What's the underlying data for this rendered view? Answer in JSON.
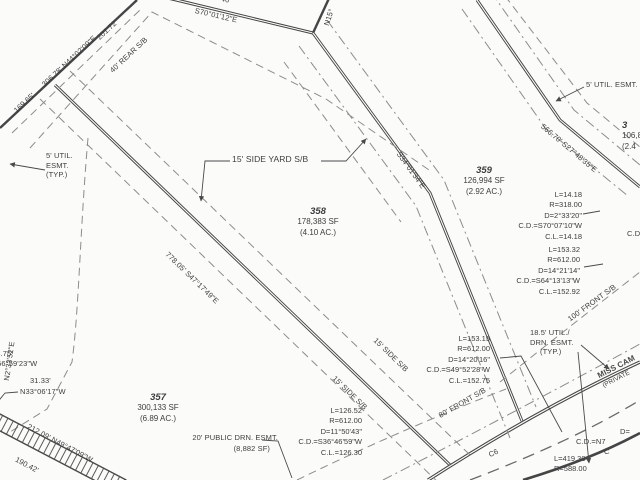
{
  "colors": {
    "ink": "#3d3d3d",
    "line": "#4a4a4a",
    "dash": "#8c8c8c",
    "background": "#fbfbf9"
  },
  "lots": {
    "lot357": {
      "number": "357",
      "area_sf": "300,133 SF",
      "area_ac": "(6.89 AC.)"
    },
    "lot358": {
      "number": "358",
      "area_sf": "178,383 SF",
      "area_ac": "(4.10 AC.)"
    },
    "lot359": {
      "number": "359",
      "area_sf": "126,994 SF",
      "area_ac": "(2.92 AC.)"
    },
    "lot_right_partial": {
      "number": "3",
      "area_sf": "106,8",
      "area_ac": "(2.4"
    }
  },
  "bearings": {
    "north_boundary": "306.78' N44°02'09\"E",
    "seg_169": "169.65'",
    "seg_201": "201.72'",
    "top_bearing": "S70°01'12\"E",
    "top_partial": "46'",
    "corner_partial": "N15°",
    "lot_line_358_359": "S34°01'34\"E",
    "lot_line_359_360": "566.70' S27°48'35\"E",
    "lot_line_357_358": "778.05' S47°17'49\"E",
    "west_partial": "N2°33'52\"E",
    "west_dist1": "43.75'",
    "west_brg1": "S56°59'23\"W",
    "west_dist2": "31.33'",
    "west_brg2": "N33°06'17\"W",
    "strip_dist1": "212.09' N49°47'09\"W",
    "strip_dist2": "190.42'"
  },
  "setbacks": {
    "rear": "40' REAR S/B",
    "side_yard": "15' SIDE YARD S/B",
    "side_a": "15' SIDE S/B",
    "side_b": "15' SIDE S/B",
    "front_100": "100' FRONT S/B",
    "front_80": "80' FRONT S/B"
  },
  "easements": {
    "util5_left": [
      "5' UTIL.",
      "ESMT.",
      "(TYP.)"
    ],
    "util5_right": "5' UTIL. ESMT.",
    "util185": [
      "18.5' UTIL./",
      "DRN. ESMT.",
      "(TYP.)"
    ],
    "drn20_line1": "20' PUBLIC DRN. ESMT.",
    "drn20_line2": "(8,882 SF)"
  },
  "road": {
    "name_partial": "MISS CAM",
    "private_partial": "(PRIVATE",
    "curve_label": "C6"
  },
  "curves": {
    "c1": [
      "L=14.18",
      "R=318.00",
      "D=2°33'20\"",
      "C.D.=S70°07'10\"W",
      "C.L.=14.18"
    ],
    "c2": [
      "L=153.32",
      "R=612.00",
      "D=14°21'14\"",
      "C.D.=S64°13'13\"W",
      "C.L.=152.92"
    ],
    "c3": [
      "L=153.15",
      "R=612.00",
      "D=14°20'16\"",
      "C.D.=S49°52'28\"W",
      "C.L.=152.75"
    ],
    "c4": [
      "L=126.52",
      "R=612.00",
      "D=11°50'43\"",
      "C.D.=S36°46'59\"W",
      "C.L.=126.30"
    ],
    "c5": [
      "L=419.30",
      "R=588.00"
    ],
    "c6_partial": [
      "D=",
      "C.D.=N7",
      "C"
    ],
    "cd_partial": "C.D"
  }
}
